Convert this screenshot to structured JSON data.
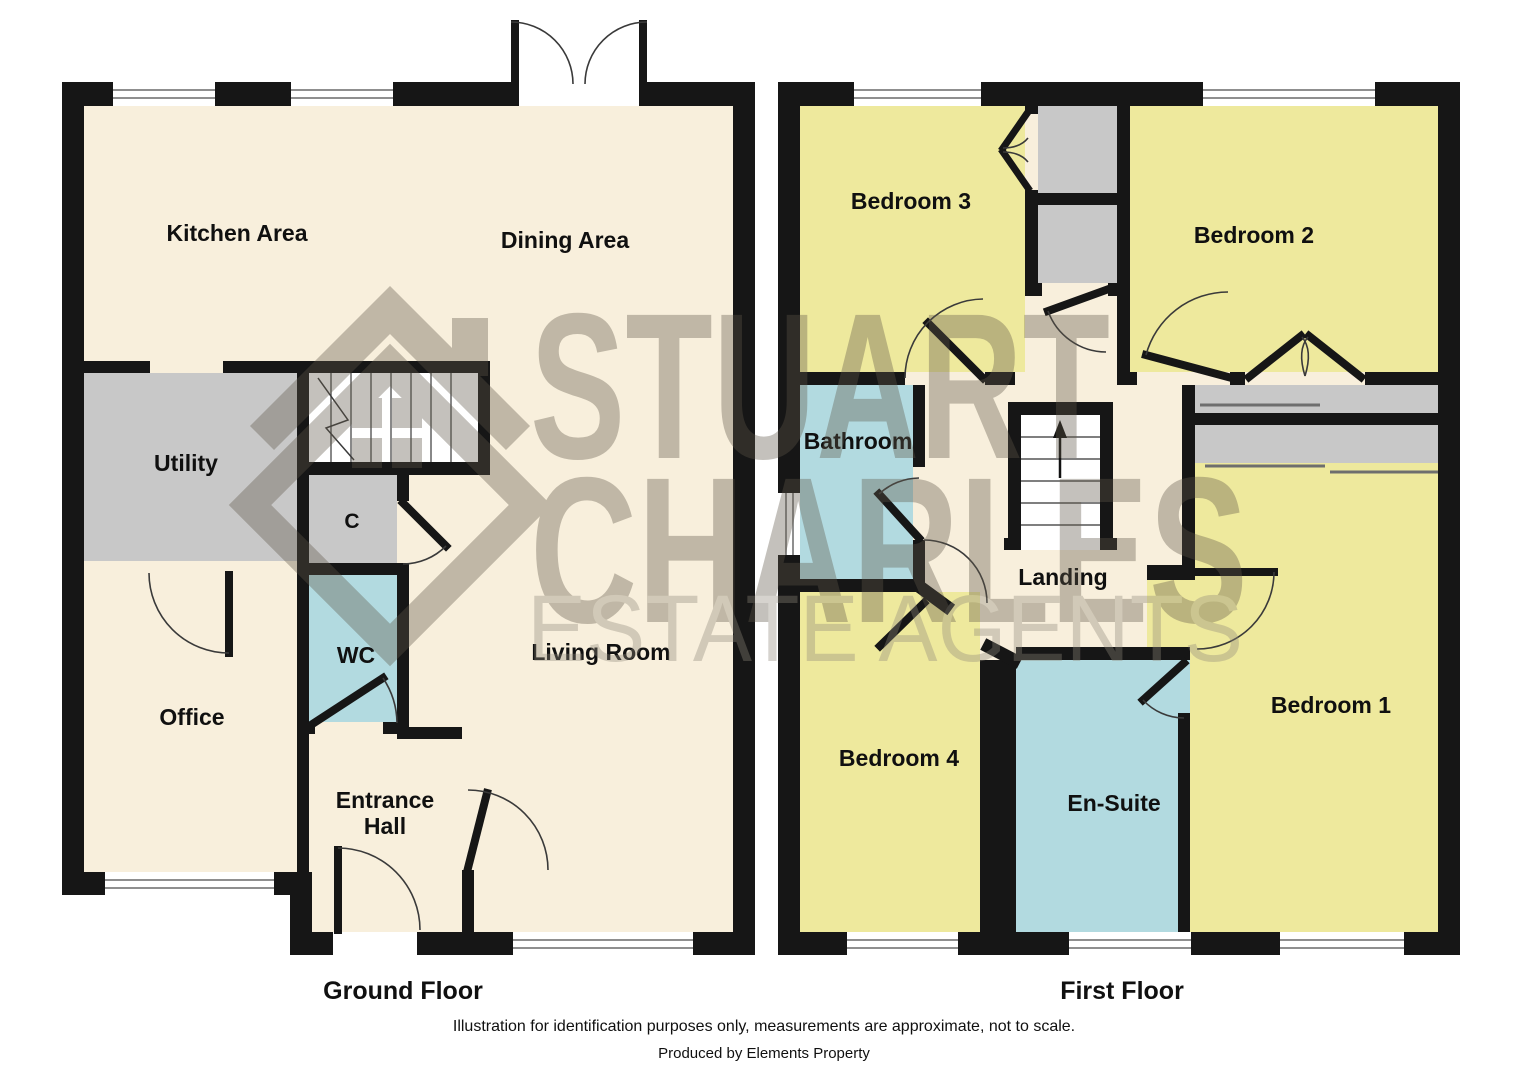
{
  "watermark": {
    "logo_icon": "house-diamond-logo",
    "line1": "STUART",
    "line2": "CHARLES",
    "line3": "ESTATE AGENTS"
  },
  "ground_floor": {
    "caption": "Ground Floor",
    "rooms": {
      "kitchen": "Kitchen Area",
      "dining": "Dining Area",
      "utility": "Utility",
      "cupboard": "C",
      "wc": "WC",
      "office": "Office",
      "entrance_line1": "Entrance",
      "entrance_line2": "Hall",
      "living": "Living Room"
    }
  },
  "first_floor": {
    "caption": "First Floor",
    "rooms": {
      "bedroom3": "Bedroom 3",
      "bedroom2": "Bedroom 2",
      "bathroom": "Bathroom",
      "landing": "Landing",
      "bedroom4": "Bedroom 4",
      "ensuite": "En-Suite",
      "bedroom1": "Bedroom 1"
    }
  },
  "footer": {
    "disclaimer": "Illustration for identification purposes only, measurements are approximate, not to scale.",
    "producer": "Produced by Elements Property"
  },
  "palette": {
    "room_cream": "#f8efdc",
    "room_yellow": "#eee99d",
    "room_blue": "#b2dae0",
    "room_gray": "#c8c8c8",
    "wall_black": "#161616",
    "watermark_gray": "#5f5748"
  }
}
